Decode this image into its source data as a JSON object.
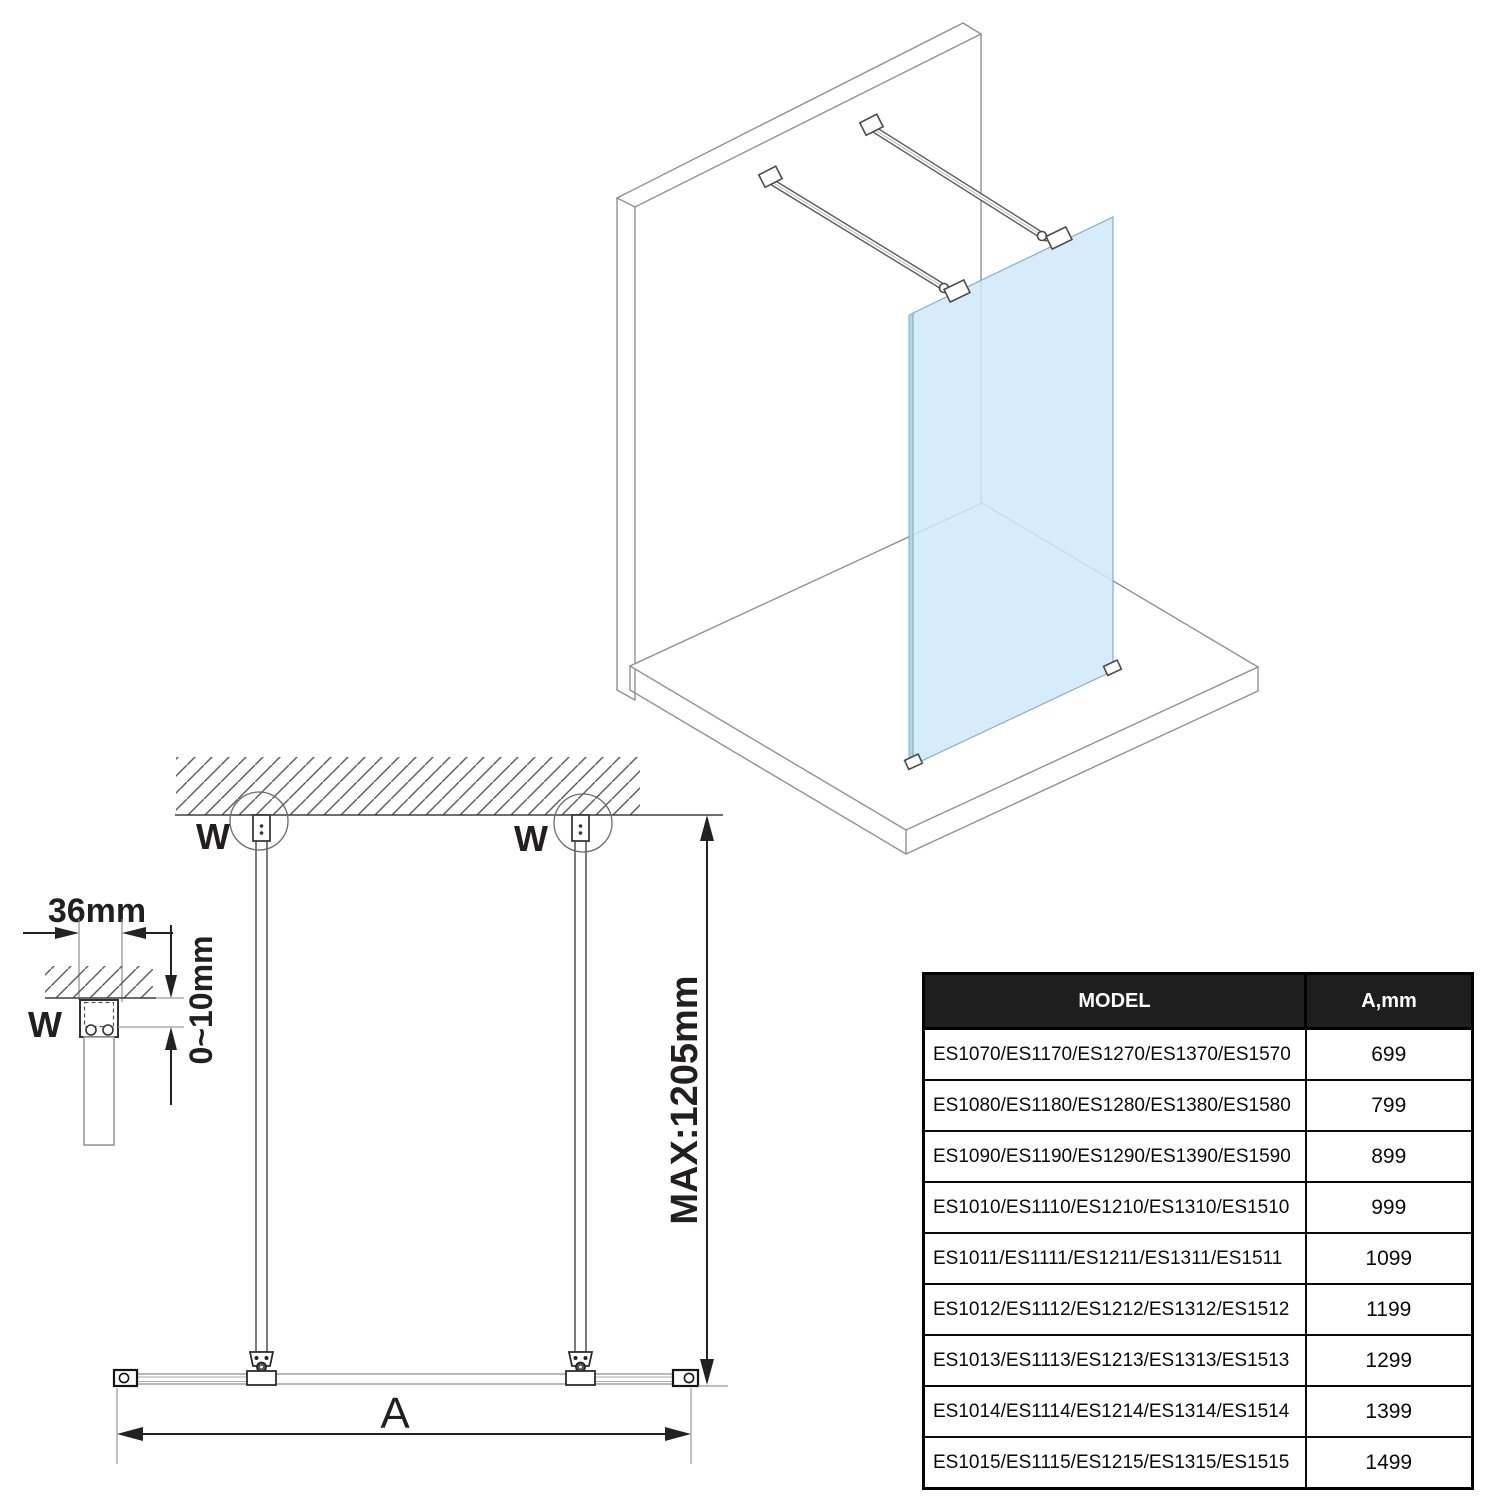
{
  "diagram": {
    "labels": {
      "w_plan_left": "W",
      "w_plan_right": "W",
      "w_detail": "W",
      "dim_bracket_width": "36mm",
      "dim_ceiling_gap": "0~10mm",
      "dim_max_height": "MAX:1205mm",
      "dim_width": "A"
    },
    "colors": {
      "glass": "#cfe9f9",
      "glass_edge": "#aed7ee",
      "line_gray": "#8f9193",
      "line_dark": "#231f20"
    }
  },
  "table": {
    "headers": {
      "model": "MODEL",
      "a_mm": "A,mm"
    },
    "rows": [
      {
        "model": "ES1070/ES1170/ES1270/ES1370/ES1570",
        "a_mm": "699"
      },
      {
        "model": "ES1080/ES1180/ES1280/ES1380/ES1580",
        "a_mm": "799"
      },
      {
        "model": "ES1090/ES1190/ES1290/ES1390/ES1590",
        "a_mm": "899"
      },
      {
        "model": "ES1010/ES1110/ES1210/ES1310/ES1510",
        "a_mm": "999"
      },
      {
        "model": "ES1011/ES1111/ES1211/ES1311/ES1511",
        "a_mm": "1099"
      },
      {
        "model": "ES1012/ES1112/ES1212/ES1312/ES1512",
        "a_mm": "1199"
      },
      {
        "model": "ES1013/ES1113/ES1213/ES1313/ES1513",
        "a_mm": "1299"
      },
      {
        "model": "ES1014/ES1114/ES1214/ES1314/ES1514",
        "a_mm": "1399"
      },
      {
        "model": "ES1015/ES1115/ES1215/ES1315/ES1515",
        "a_mm": "1499"
      }
    ]
  }
}
